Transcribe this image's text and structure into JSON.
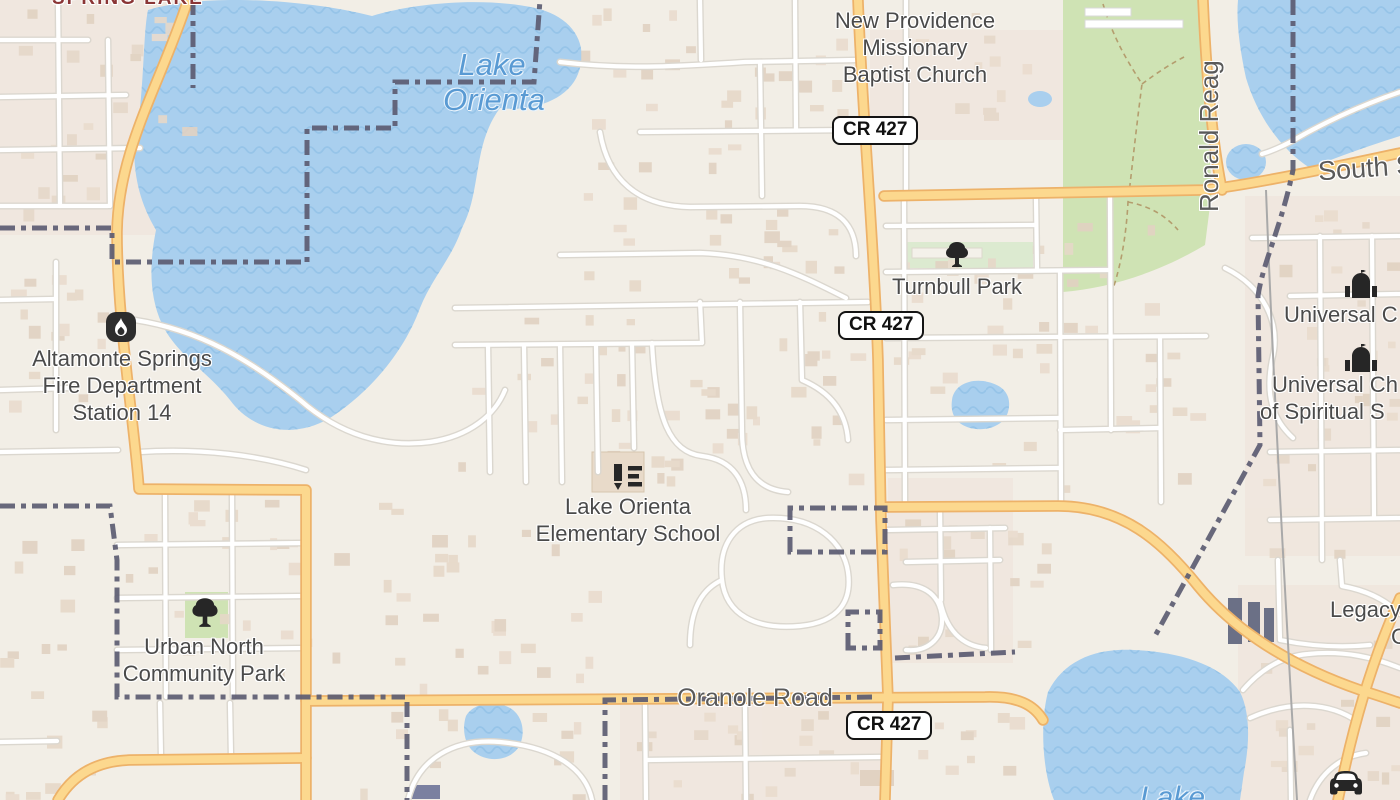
{
  "map_labels": {
    "neighborhood_top_left": "SPRING LAKE",
    "lake_orienta": {
      "line1": "Lake",
      "line2": "Orienta"
    },
    "lake_bottom_right": "Lake",
    "church_new_providence": {
      "line1": "New Providence",
      "line2": "Missionary",
      "line3": "Baptist Church"
    },
    "turnbull_park": "Turnbull Park",
    "fire_station": {
      "line1": "Altamonte Springs",
      "line2": "Fire Department",
      "line3": "Station 14"
    },
    "school": {
      "line1": "Lake Orienta",
      "line2": "Elementary School"
    },
    "urban_north_park": {
      "line1": "Urban North",
      "line2": "Community Park"
    },
    "universal_college": "Universal C",
    "universal_church": {
      "line1": "Universal Ch",
      "line2": "of Spiritual S"
    },
    "legacy": {
      "line1": "Legacy",
      "line2": "C"
    },
    "roads": {
      "oranole": "Oranole Road",
      "ronald_reagan": "Ronald Reag",
      "south_street": "South S"
    },
    "route_shield": "CR 427"
  },
  "icons": {
    "fire": "flame-icon",
    "turnbull": "tree-icon",
    "urban_north": "tree-icon",
    "school": "school-icon",
    "universal_college": "church-icon",
    "universal_church": "church-icon",
    "car": "car-icon"
  },
  "colors": {
    "land": "#f2eee6",
    "residential_tint": "#efe2d8",
    "water": "#a9cfee",
    "water_wave": "#90c0e6",
    "water_label": "#599ad3",
    "park_green": "#cfe3b4",
    "road_major_fill": "#fcd88e",
    "road_major_casing": "#edb269",
    "road_minor_fill": "#ffffff",
    "road_minor_casing": "#dbd7cf",
    "boundary": "#5c5c72",
    "building": "#e4d5c6",
    "poi_text": "#4a4a4a",
    "neighborhood_text": "#8a3535",
    "shield_border": "#141414"
  }
}
